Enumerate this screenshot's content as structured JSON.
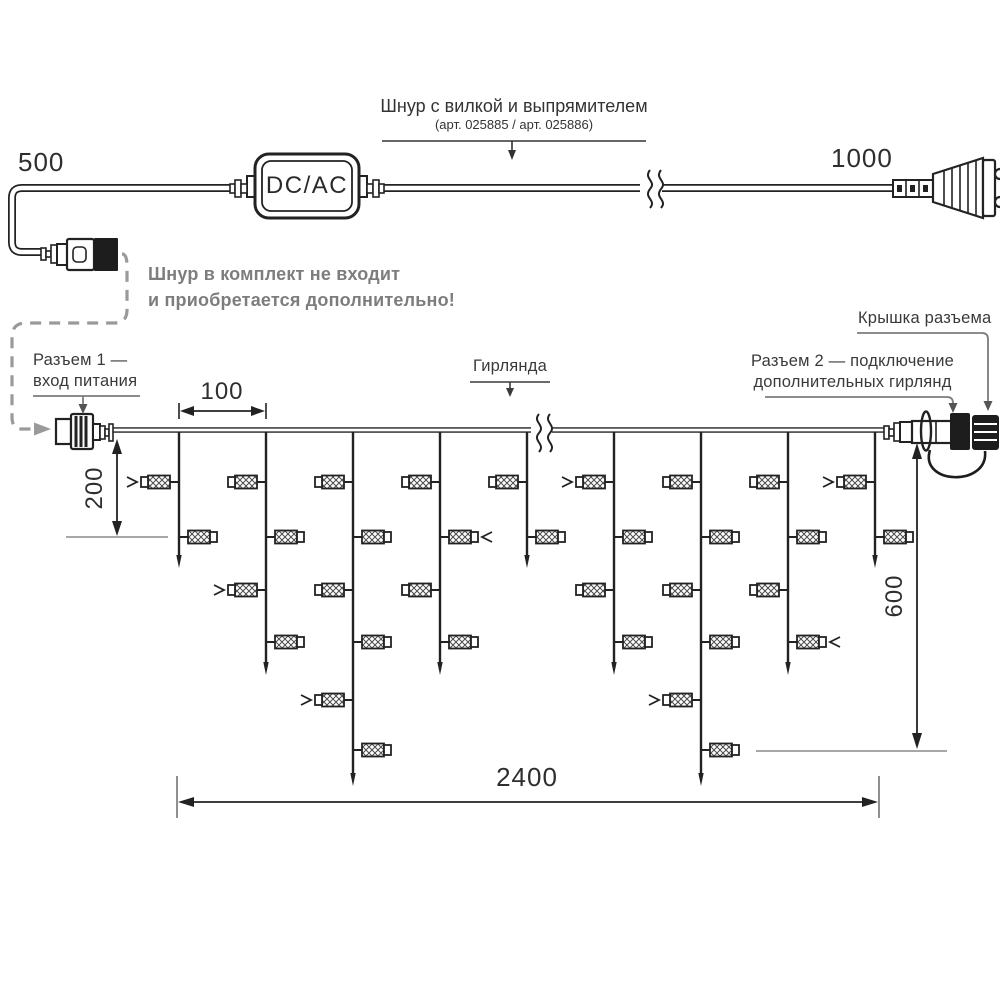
{
  "labels": {
    "dim_500": "500",
    "dim_1000": "1000",
    "dcac": "DC/AC",
    "cord_title": "Шнур с вилкой и выпрямителем",
    "cord_subtitle": "(арт. 025885 / арт. 025886)",
    "warning_line1": "Шнур в комплект не входит",
    "warning_line2": "и приобретается дополнительно!",
    "connector1_line1": "Разъем 1 —",
    "connector1_line2": "вход питания",
    "garland": "Гирлянда",
    "connector2_line1": "Разъем 2 — подключение",
    "connector2_line2": "дополнительных гирлянд",
    "cap": "Крышка разъема",
    "dim_100": "100",
    "dim_200": "200",
    "dim_600": "600",
    "dim_2400": "2400"
  },
  "colors": {
    "line": "#222222",
    "gray_callout": "#808080",
    "warning_text": "#7d7d7d",
    "connector_black": "#1d1d1d"
  },
  "garland_spec": {
    "wire_y": 430,
    "bulb_levels": [
      482,
      537,
      590,
      642,
      700,
      750
    ],
    "drops": [
      {
        "x": 179,
        "tip": 568,
        "bulbs": [
          {
            "l": 0,
            "side": "L",
            "mark": true
          },
          {
            "l": 1,
            "side": "R",
            "mark": false
          }
        ]
      },
      {
        "x": 266,
        "tip": 675,
        "bulbs": [
          {
            "l": 0,
            "side": "L",
            "mark": false
          },
          {
            "l": 1,
            "side": "R",
            "mark": false
          },
          {
            "l": 2,
            "side": "L",
            "mark": true
          },
          {
            "l": 3,
            "side": "R",
            "mark": false
          }
        ]
      },
      {
        "x": 353,
        "tip": 786,
        "bulbs": [
          {
            "l": 0,
            "side": "L",
            "mark": false
          },
          {
            "l": 1,
            "side": "R",
            "mark": false
          },
          {
            "l": 2,
            "side": "L",
            "mark": false
          },
          {
            "l": 3,
            "side": "R",
            "mark": false
          },
          {
            "l": 4,
            "side": "L",
            "mark": true
          },
          {
            "l": 5,
            "side": "R",
            "mark": false
          }
        ]
      },
      {
        "x": 440,
        "tip": 675,
        "bulbs": [
          {
            "l": 0,
            "side": "L",
            "mark": false
          },
          {
            "l": 1,
            "side": "R",
            "mark": true
          },
          {
            "l": 2,
            "side": "L",
            "mark": false
          },
          {
            "l": 3,
            "side": "R",
            "mark": false
          }
        ]
      },
      {
        "x": 527,
        "tip": 568,
        "bulbs": [
          {
            "l": 0,
            "side": "L",
            "mark": false
          },
          {
            "l": 1,
            "side": "R",
            "mark": false
          }
        ]
      },
      {
        "x": 614,
        "tip": 675,
        "bulbs": [
          {
            "l": 0,
            "side": "L",
            "mark": true
          },
          {
            "l": 1,
            "side": "R",
            "mark": false
          },
          {
            "l": 2,
            "side": "L",
            "mark": false
          },
          {
            "l": 3,
            "side": "R",
            "mark": false
          }
        ]
      },
      {
        "x": 701,
        "tip": 786,
        "bulbs": [
          {
            "l": 0,
            "side": "L",
            "mark": false
          },
          {
            "l": 1,
            "side": "R",
            "mark": false
          },
          {
            "l": 2,
            "side": "L",
            "mark": false
          },
          {
            "l": 3,
            "side": "R",
            "mark": false
          },
          {
            "l": 4,
            "side": "L",
            "mark": true
          },
          {
            "l": 5,
            "side": "R",
            "mark": false
          }
        ]
      },
      {
        "x": 788,
        "tip": 675,
        "bulbs": [
          {
            "l": 0,
            "side": "L",
            "mark": false
          },
          {
            "l": 1,
            "side": "R",
            "mark": false
          },
          {
            "l": 2,
            "side": "L",
            "mark": false
          },
          {
            "l": 3,
            "side": "R",
            "mark": true
          }
        ]
      },
      {
        "x": 875,
        "tip": 568,
        "bulbs": [
          {
            "l": 0,
            "side": "L",
            "mark": true
          },
          {
            "l": 1,
            "side": "R",
            "mark": false
          }
        ]
      }
    ]
  }
}
